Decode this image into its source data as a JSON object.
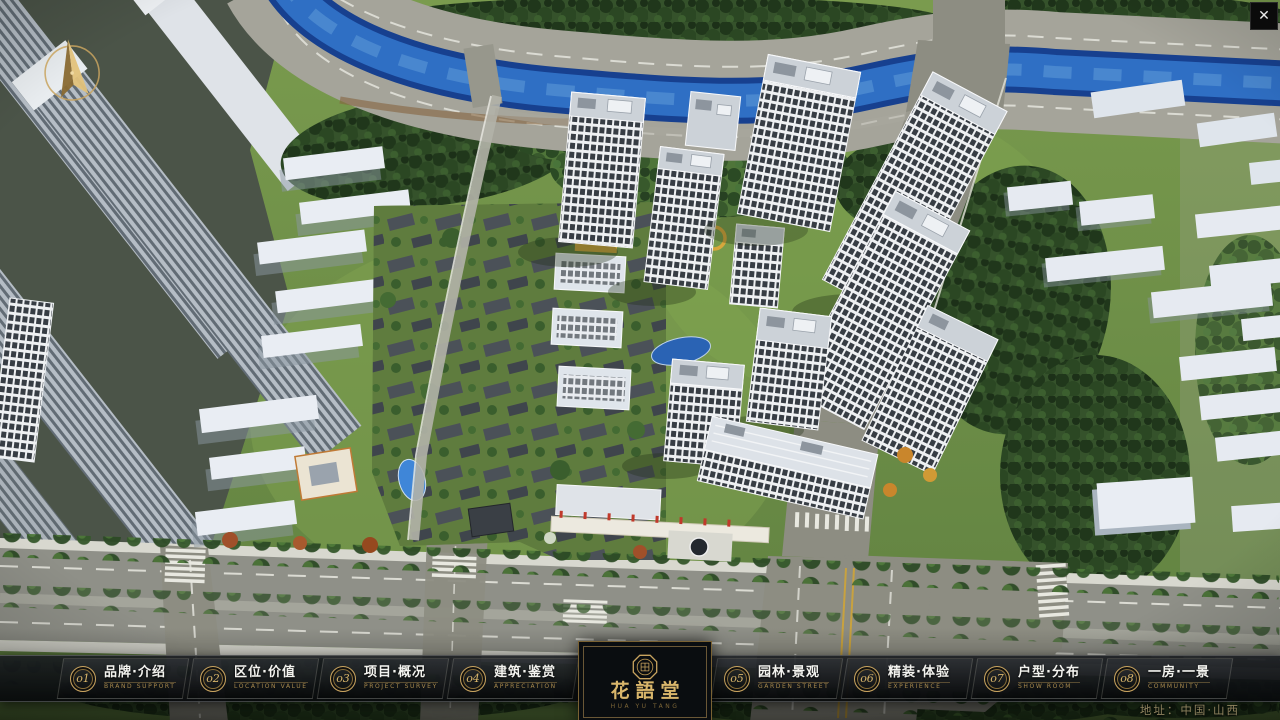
{
  "chrome": {
    "close_glyph": "✕"
  },
  "logo": {
    "title": "花語堂",
    "caption": "HUA YU TANG"
  },
  "footer": {
    "address": "地址：中国·山西"
  },
  "nav": {
    "items": [
      {
        "num": "o1",
        "zh": "品牌·介绍",
        "en": "BRAND SUPPORT"
      },
      {
        "num": "o2",
        "zh": "区位·价值",
        "en": "LOCATION VALUE"
      },
      {
        "num": "o3",
        "zh": "项目·概况",
        "en": "PROJECT SURVEY"
      },
      {
        "num": "o4",
        "zh": "建筑·鉴赏",
        "en": "APPRECIATION"
      },
      {
        "num": "o5",
        "zh": "园林·景观",
        "en": "GARDEN STREET"
      },
      {
        "num": "o6",
        "zh": "精装·体验",
        "en": "EXPERIENCE"
      },
      {
        "num": "o7",
        "zh": "户型·分布",
        "en": "SHOW ROOM"
      },
      {
        "num": "o8",
        "zh": "一房·一景",
        "en": "COMMUNITY"
      }
    ]
  }
}
